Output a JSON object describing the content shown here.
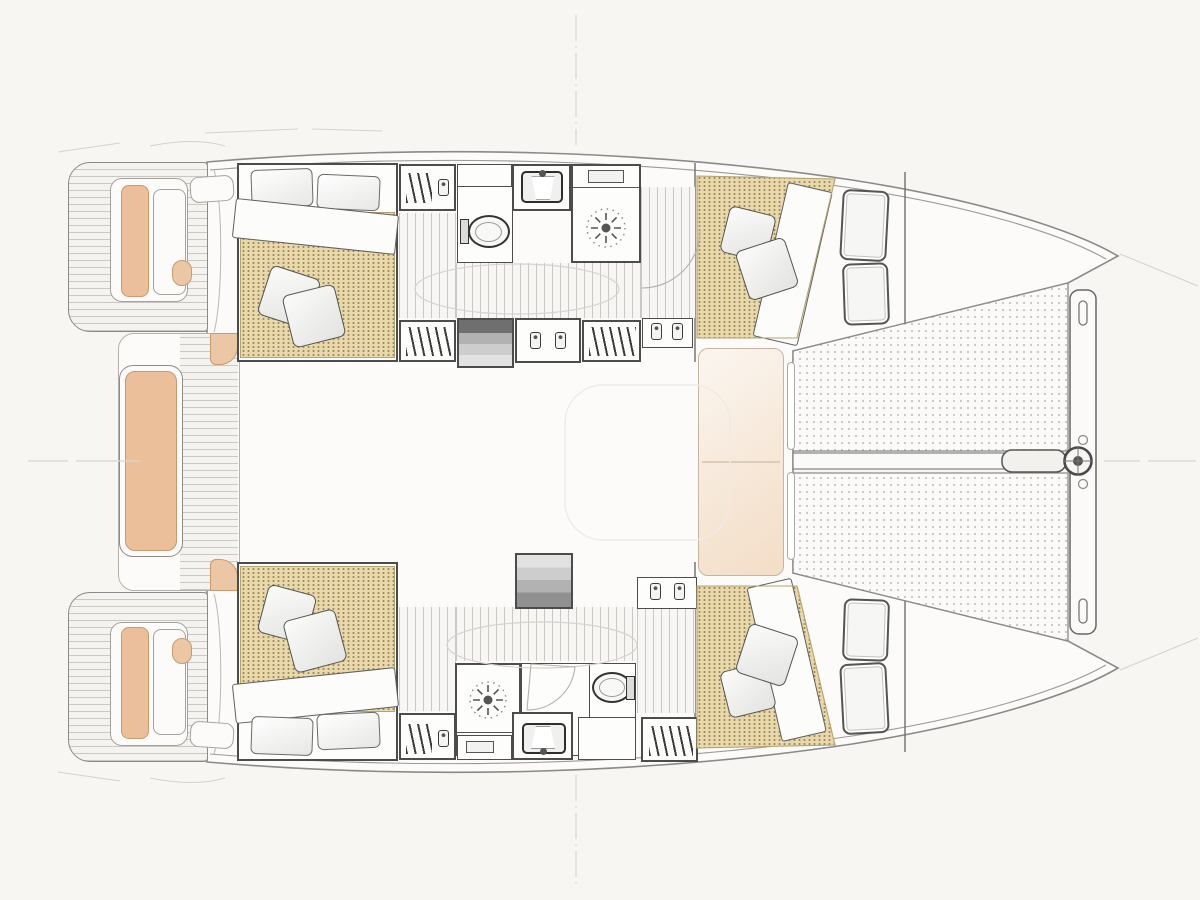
{
  "document": {
    "kind": "catamaran-deck-and-accommodation-plan",
    "orientation": "bow-right-stern-left",
    "visible_text": [],
    "hulls": 2,
    "cabins": 4,
    "bathrooms": 2
  },
  "colors": {
    "background": "#f7f6f3",
    "deck": "#fcfbf9",
    "outline": "#4c4c4c",
    "outline-light": "#8a8a8a",
    "mattress": "#e8d8ab",
    "mattress-dot": "#9d8a58",
    "cushion": "#eabf9a",
    "cushion-border": "#c89a70",
    "teak-line": "#cbc8c3",
    "sunpad": "#f3ddc7",
    "trampoline-dot": "#bdb9b1",
    "axis": "#d9d6d2"
  },
  "areas": {
    "swim_platform_port": {
      "label": "swim platform (port)"
    },
    "swim_platform_starboard": {
      "label": "swim platform (starboard)"
    },
    "stern_seat_port": {
      "label": "stern seat (port)"
    },
    "stern_seat_starboard": {
      "label": "stern seat (starboard)"
    },
    "aft_cockpit_bench": {
      "label": "aft cockpit bench"
    },
    "cockpit": {
      "label": "cockpit"
    },
    "saloon": {
      "label": "saloon / bridgedeck"
    },
    "aft_cabin_port": {
      "label": "aft cabin (port)"
    },
    "aft_cabin_starboard": {
      "label": "aft cabin (starboard)"
    },
    "forward_cabin_port": {
      "label": "forward cabin (port)"
    },
    "forward_cabin_starboard": {
      "label": "forward cabin (starboard)"
    },
    "bathroom_port": {
      "label": "bathroom (port)"
    },
    "bathroom_starboard": {
      "label": "bathroom (starboard)"
    },
    "companionway_port": {
      "label": "companionway steps (port)"
    },
    "companionway_starboard": {
      "label": "companionway steps (starboard)"
    },
    "foredeck_sunpad": {
      "label": "foredeck seat / sunpad"
    },
    "trampoline": {
      "label": "trampoline"
    },
    "crossbeam": {
      "label": "forward crossbeam"
    },
    "anchor_roller": {
      "label": "anchor roller fitting"
    }
  },
  "icons": {
    "shower_drain": "sun-rays-drain",
    "wardrobe": "clothes-hangers",
    "toilet": "wc-bowl",
    "sink": "basin-with-faucet",
    "stairs": "companionway-steps",
    "jar": "toiletry-jar"
  }
}
